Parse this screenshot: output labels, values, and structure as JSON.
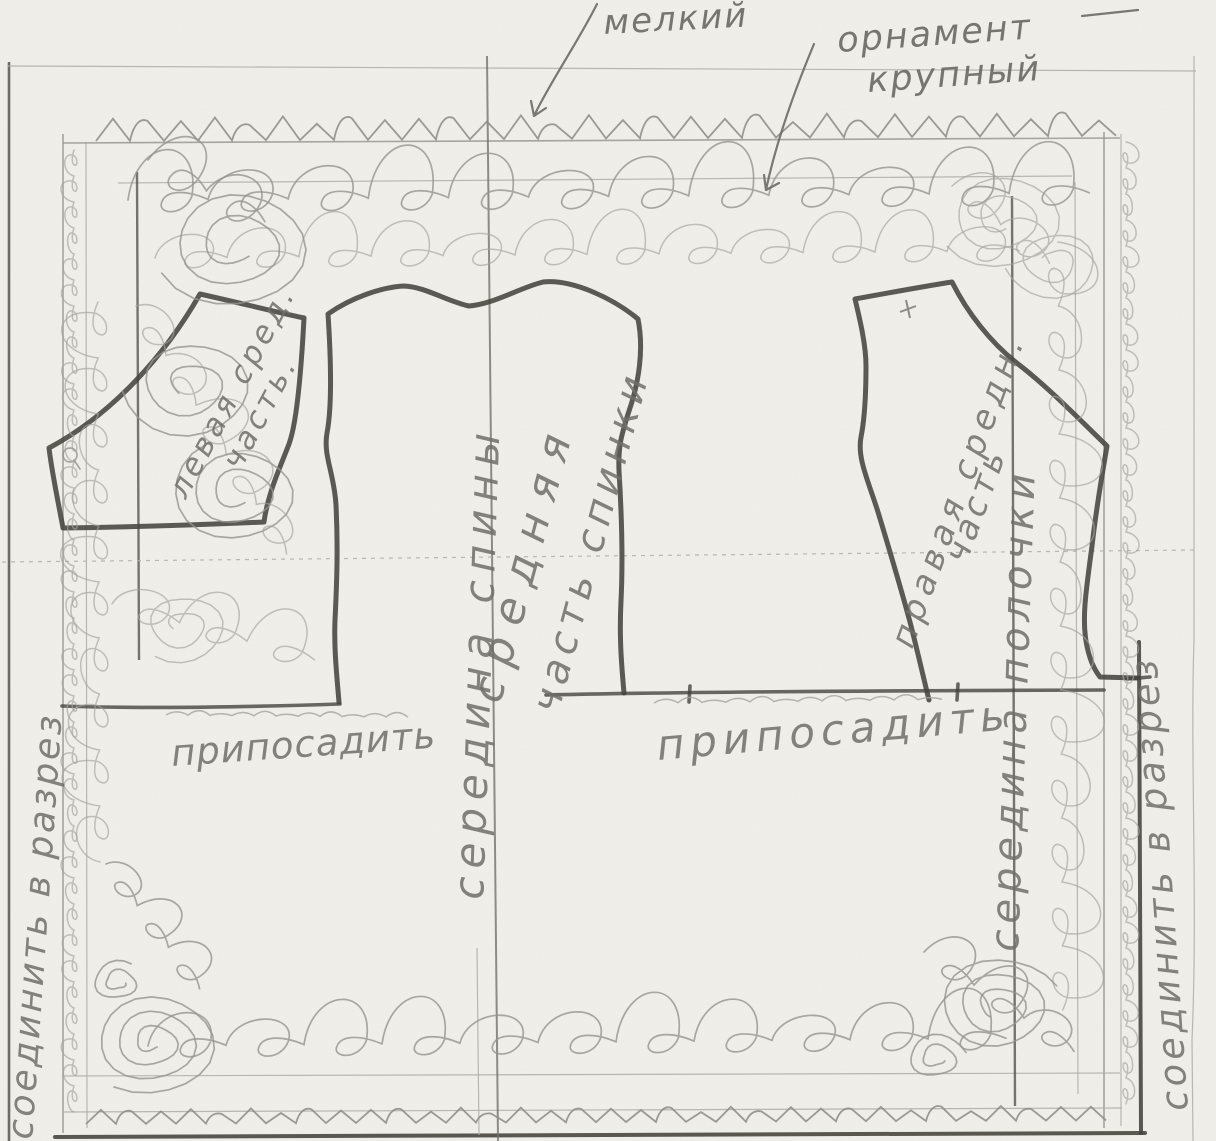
{
  "annotations": {
    "ornament_small": "мелкий",
    "ornament_large_word1": "орнамент",
    "ornament_large_word2": "крупный"
  },
  "pattern_pieces": {
    "left": {
      "label_line1": "левая сред.",
      "label_line2": "часть."
    },
    "center": {
      "label_line1": "средняя",
      "label_line2": "часть спинки"
    },
    "right": {
      "label_line1": "правая средн.",
      "label_line2": "часть"
    }
  },
  "fold_lines": {
    "center_back": "середина спины",
    "center_front": "середина полочки"
  },
  "sewing_notes": {
    "ease_left": "припосадить",
    "ease_right": "припосадить",
    "join_left": "соединить в разрез",
    "join_right": "соединить в разрез"
  },
  "colors": {
    "paper": "#f1efe9",
    "pencil_dark": "#45443e",
    "pencil_mid": "#74726c",
    "pencil_light": "#a5a39c"
  }
}
